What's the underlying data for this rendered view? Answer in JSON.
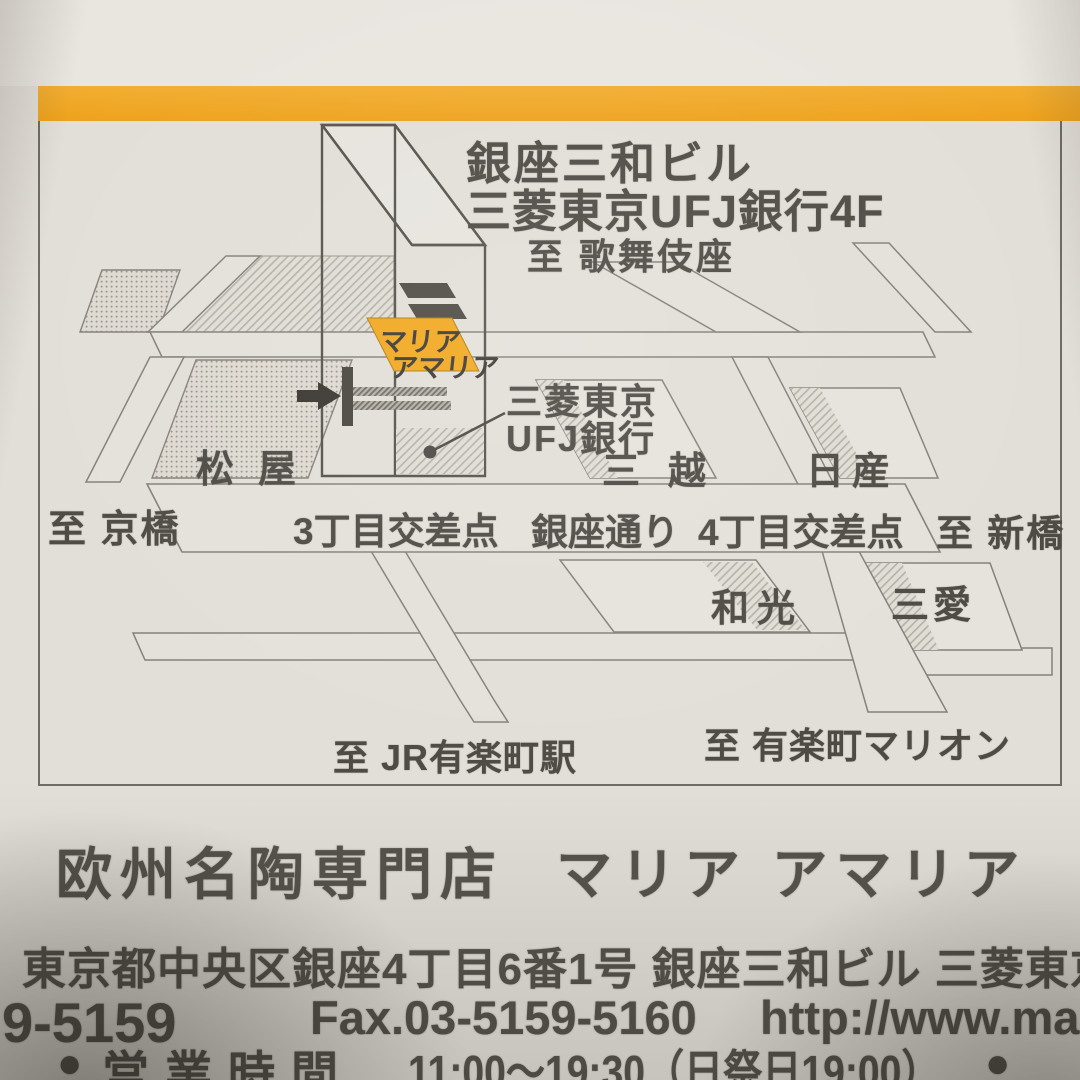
{
  "colors": {
    "accent_bar": "#efa625",
    "shop_highlight": "#f1a820",
    "paper": "#e2dfd8",
    "ink": "#4b4843"
  },
  "map": {
    "building": {
      "name_line1": "銀座三和ビル",
      "name_line2": "三菱東京UFJ銀行4F"
    },
    "shop_sign": {
      "line1": "マリア",
      "line2": "アマリア"
    },
    "bank_callout": {
      "line1": "三菱東京",
      "line2": "UFJ銀行"
    },
    "directions": {
      "kabukiza": "至 歌舞伎座",
      "kyobashi": "至 京橋",
      "shimbashi": "至 新橋",
      "jr_yurakucho": "至 JR有楽町駅",
      "marion": "至 有楽町マリオン"
    },
    "landmarks": {
      "matsuya": "松屋",
      "mitsukoshi": "三越",
      "nissan": "日産",
      "wako": "和光",
      "sanai": "三愛"
    },
    "roads": {
      "sanchome_crossing": "3丁目交差点",
      "ginza_dori": "銀座通り",
      "yonchome_crossing": "4丁目交差点"
    }
  },
  "footer": {
    "shop_category": "欧州名陶専門店",
    "shop_name": "マリア アマリア",
    "address": "東京都中央区銀座4丁目6番1号 銀座三和ビル 三菱東京",
    "tel_fragment": "9-5159",
    "fax": "Fax.03-5159-5160",
    "url_fragment": "http://www.mar",
    "hours_prefix": "●",
    "hours_label": "営業時間",
    "hours_value": "11:00〜19:30（日祭日19:00）",
    "hours_suffix": "●"
  }
}
